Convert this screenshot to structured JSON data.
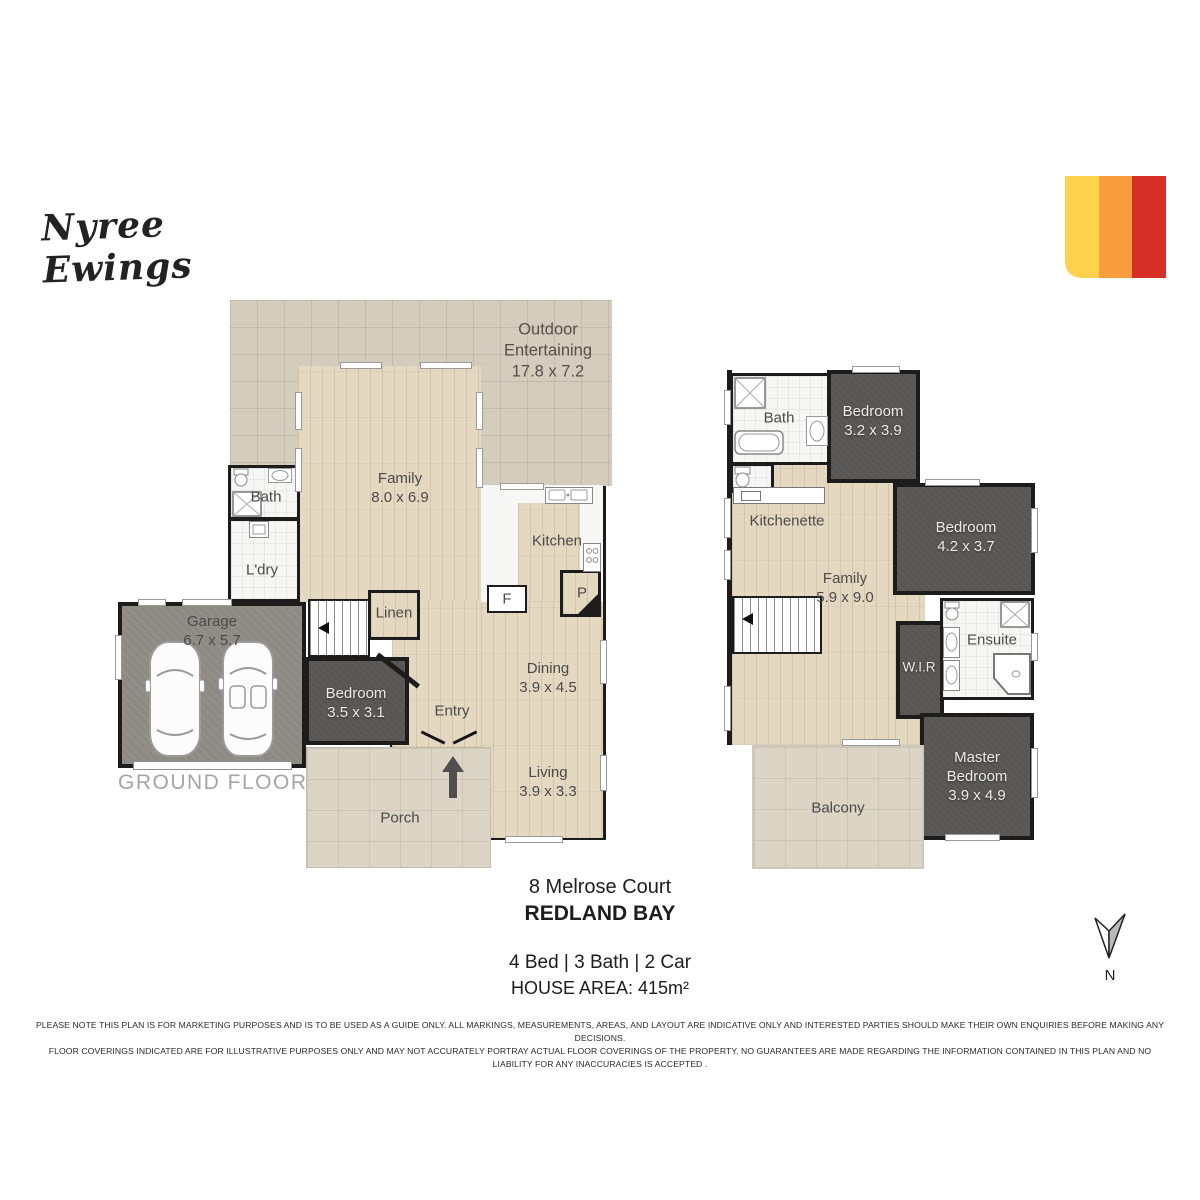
{
  "agent": {
    "signature": "Nyree Ewings"
  },
  "brand": {
    "colors": {
      "yellow": "#ffd14d",
      "orange": "#f89c3e",
      "red": "#d62f28"
    }
  },
  "ground_floor": {
    "caption": "GROUND FLOOR",
    "rooms": {
      "outdoor": {
        "name": "Outdoor Entertaining",
        "dims": "17.8 x 7.2"
      },
      "family": {
        "name": "Family",
        "dims": "8.0 x 6.9"
      },
      "bath": {
        "name": "Bath"
      },
      "ldry": {
        "name": "L'dry"
      },
      "kitchen": {
        "name": "Kitchen"
      },
      "garage": {
        "name": "Garage",
        "dims": "6.7 x 5.7"
      },
      "linen": {
        "name": "Linen"
      },
      "bedroom": {
        "name": "Bedroom",
        "dims": "3.5 x 3.1"
      },
      "entry": {
        "name": "Entry"
      },
      "dining": {
        "name": "Dining",
        "dims": "3.9 x 4.5"
      },
      "living": {
        "name": "Living",
        "dims": "3.9 x 3.3"
      },
      "porch": {
        "name": "Porch"
      },
      "fridge": {
        "name": "F"
      },
      "pantry": {
        "name": "P"
      }
    }
  },
  "upper_floor": {
    "rooms": {
      "bath": {
        "name": "Bath"
      },
      "bedroom2": {
        "name": "Bedroom",
        "dims": "3.2 x 3.9"
      },
      "kitchenette": {
        "name": "Kitchenette"
      },
      "family": {
        "name": "Family",
        "dims": "5.9 x 9.0"
      },
      "bedroom3": {
        "name": "Bedroom",
        "dims": "4.2 x 3.7"
      },
      "ensuite": {
        "name": "Ensuite"
      },
      "wir": {
        "name": "W.I.R"
      },
      "master": {
        "name": "Master Bedroom",
        "dims": "3.9 x 4.9"
      },
      "balcony": {
        "name": "Balcony"
      }
    }
  },
  "property": {
    "address_line1": "8 Melrose Court",
    "address_line2": "REDLAND BAY",
    "features": "4 Bed | 3 Bath | 2 Car",
    "house_area": "HOUSE AREA: 415m²"
  },
  "compass": {
    "label": "N"
  },
  "disclaimer": {
    "line1": "PLEASE NOTE THIS PLAN IS FOR MARKETING PURPOSES AND IS TO BE USED AS A GUIDE ONLY.  ALL MARKINGS, MEASUREMENTS, AREAS, AND LAYOUT ARE INDICATIVE ONLY AND INTERESTED PARTIES SHOULD MAKE THEIR OWN ENQUIRIES BEFORE MAKING ANY DECISIONS.",
    "line2": "FLOOR COVERINGS INDICATED ARE FOR ILLUSTRATIVE PURPOSES ONLY AND MAY NOT ACCURATELY PORTRAY ACTUAL FLOOR COVERINGS OF THE PROPERTY.  NO GUARANTEES ARE MADE REGARDING THE INFORMATION CONTAINED IN THIS PLAN AND NO LIABILITY FOR  ANY INACCURACIES IS ACCEPTED ."
  }
}
